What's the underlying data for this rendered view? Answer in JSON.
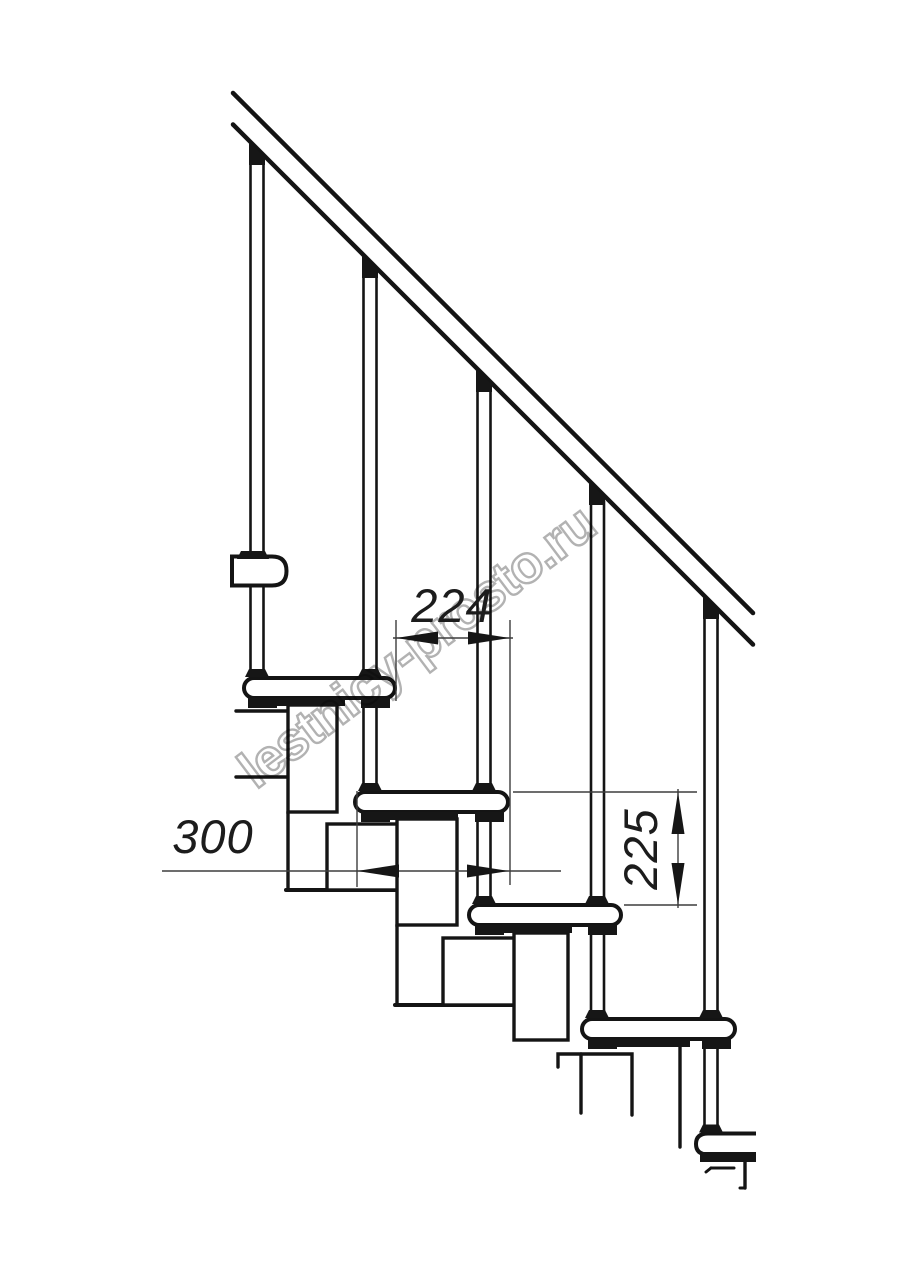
{
  "title": "Modular staircase side-view technical drawing",
  "watermark": {
    "text": "lestnicy-prosto.ru",
    "color": "#b2b2b2"
  },
  "dimensions": {
    "run": {
      "value": "224"
    },
    "depth": {
      "value": "300"
    },
    "rise": {
      "value": "225"
    }
  },
  "colors": {
    "background": "#ffffff",
    "line": "#141414",
    "dimension_line": "#3d3d3d",
    "dimension_text": "#1c1c1c"
  }
}
